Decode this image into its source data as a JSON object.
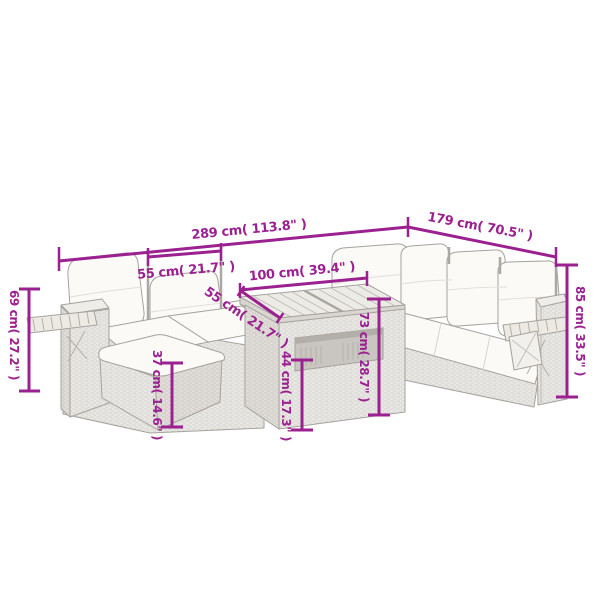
{
  "title": "Garden furniture set dimension diagram",
  "colors": {
    "dimension_accent": "#9B2190",
    "background": "#FFFFFF",
    "furniture_outline": "#A5A29D",
    "cushion_fill": "#FBFAF7",
    "wicker_fill": "#E9E7E3"
  },
  "dim_labels": {
    "overall_width": "289 cm( 113.8\" )",
    "right_section_width": "179 cm( 70.5\" )",
    "seat_width": "55 cm( 21.7\" )",
    "table_top_length": "100 cm( 39.4\" )",
    "table_top_depth": "55 cm( 21.7\" )",
    "armrest_height": "69 cm( 27.2\" )",
    "footstool_height": "37 cm( 14.6\" )",
    "table_shelf_height": "44 cm( 17.3\" )",
    "table_height": "73 cm( 28.7\" )",
    "backrest_height": "85 cm( 33.5\" )"
  },
  "measurements": [
    {
      "part": "overall-width-left-wing",
      "cm": 289,
      "inch": 113.8
    },
    {
      "part": "right-wing-width",
      "cm": 179,
      "inch": 70.5
    },
    {
      "part": "seat-module-width",
      "cm": 55,
      "inch": 21.7
    },
    {
      "part": "table-top-length",
      "cm": 100,
      "inch": 39.4
    },
    {
      "part": "table-top-depth",
      "cm": 55,
      "inch": 21.7
    },
    {
      "part": "armrest-height",
      "cm": 69,
      "inch": 27.2
    },
    {
      "part": "footstool-height",
      "cm": 37,
      "inch": 14.6
    },
    {
      "part": "table-shelf-height",
      "cm": 44,
      "inch": 17.3
    },
    {
      "part": "table-height",
      "cm": 73,
      "inch": 28.7
    },
    {
      "part": "backrest-height",
      "cm": 85,
      "inch": 33.5
    }
  ]
}
